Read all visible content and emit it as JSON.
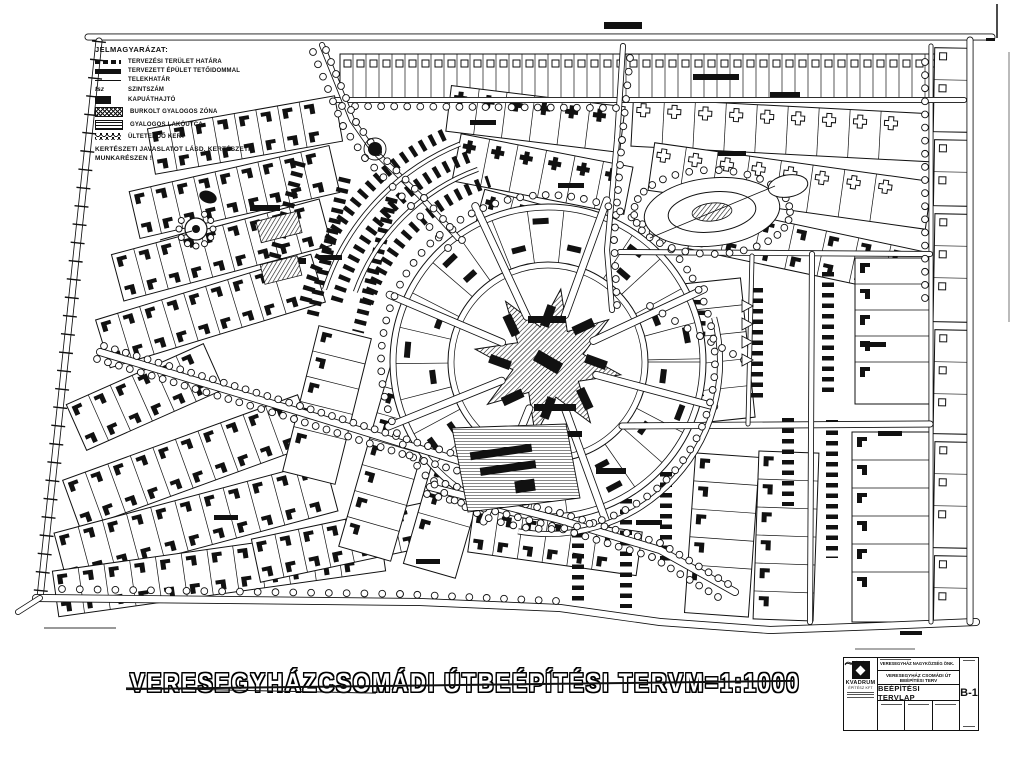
{
  "legend": {
    "title": "JELMAGYARÁZAT:",
    "items": [
      {
        "symbol": "dashed-boundary",
        "label": "TERVEZÉSI TERÜLET HATÁRA"
      },
      {
        "symbol": "solid-bar",
        "label": "TERVEZETT ÉPÜLET TETŐIDOMMAL"
      },
      {
        "symbol": "thin-line",
        "label": "TELEKHATÁR"
      },
      {
        "symbol": "text-fsz",
        "symbol_text": "fsz",
        "label": "SZINTSZÁM"
      },
      {
        "symbol": "black-block",
        "label": "KAPUÁTHAJTÓ"
      },
      {
        "symbol": "cross-hatch",
        "label": "BURKOLT GYALOGOS ZÓNA"
      },
      {
        "symbol": "horizontal-stripes",
        "label": "GYALOGOS LAKÓUTCA"
      },
      {
        "symbol": "scallop",
        "label": "ÜLTETENDŐ KERT"
      }
    ],
    "note_line1": "KERTÉSZETI JAVASLATOT LÁSD. KERTÉSZETI",
    "note_line2": "MUNKARÉSZEN !"
  },
  "title": {
    "segments": [
      "VERESEGYHÁZ",
      "CSOMÁDI ÚT",
      "BEÉPÍTÉSI TERV",
      "M=1:1000"
    ]
  },
  "title_block": {
    "company": "KVADRUM",
    "company_sub": "ÉPÍTÉSZ KFT",
    "client": "VERESEGYHÁZ NAGYKÖZSÉG ÖNK.",
    "project": "VERESEGYHÁZ CSOMÁDI ÚT BEÉPÍTÉSI TERV",
    "sheet_title": "BEÉPÍTÉSI TERVLAP",
    "drawing_number": "B-1"
  },
  "colors": {
    "ink": "#111111",
    "paper": "#ffffff"
  }
}
